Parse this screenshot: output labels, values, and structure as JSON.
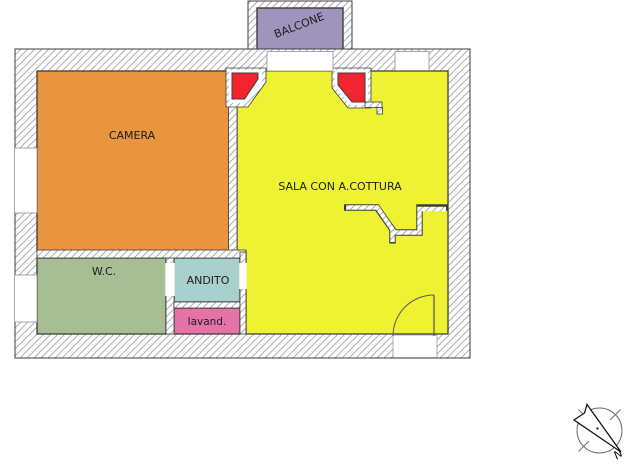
{
  "floorplan": {
    "rooms": {
      "balcone": {
        "label": "BALCONE",
        "color": "#9e94bc"
      },
      "camera": {
        "label": "CAMERA",
        "color": "#e9953f"
      },
      "sala": {
        "label": "SALA CON A.COTTURA",
        "color": "#eef233"
      },
      "wc": {
        "label": "W.C.",
        "color": "#a7bd93"
      },
      "andito": {
        "label": "ANDITO",
        "color": "#a8d0cd"
      },
      "lavanderia": {
        "label": "lavand.",
        "color": "#e573a7"
      }
    },
    "highlight_color": "#f3232f",
    "wall_hatch_color": "#a2a7ad",
    "outline_color": "#3c3c3c",
    "compass": {
      "north_label": "N"
    }
  }
}
